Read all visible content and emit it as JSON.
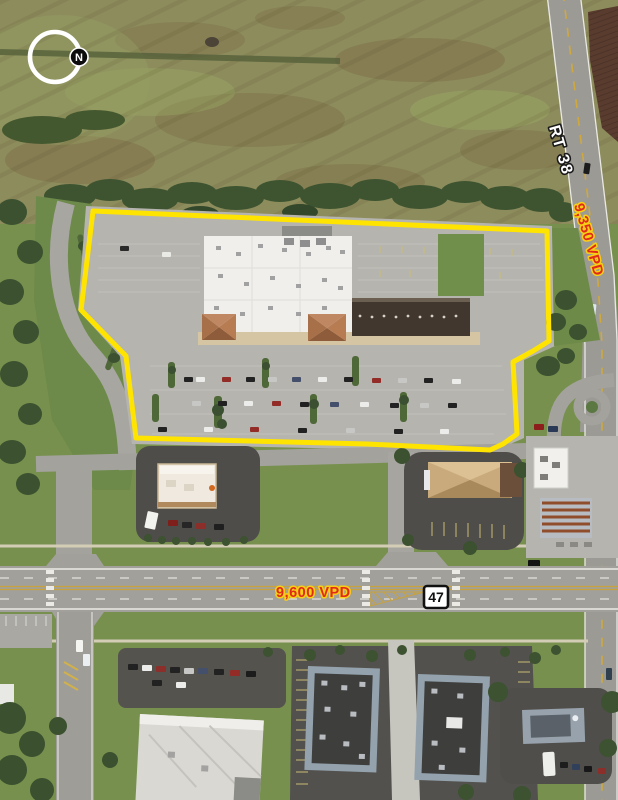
{
  "map": {
    "type": "retail-aerial",
    "compass": {
      "north_label": "N"
    },
    "property_outline": {
      "color_name": "yellow",
      "style": "solid"
    },
    "roads": [
      {
        "name": "RT 38",
        "label": "RT 38",
        "traffic_count": "9,350 VPD",
        "orientation": "diagonal-northeast"
      },
      {
        "name": "Route 47",
        "shield": "47",
        "traffic_count": "9,600 VPD",
        "orientation": "east-west"
      }
    ],
    "labels": {
      "rt38": "RT 38",
      "rt38_vpd": "9,350 VPD",
      "route47_vpd": "9,600 VPD",
      "route47_shield": "47",
      "compass_n": "N"
    },
    "colors": {
      "outline-yellow": "#FFE400",
      "vpd-red": "#E02A1C",
      "vpd-halo": "#F8CF15",
      "road-label-fill": "#FFFFFF",
      "road-label-stroke": "#1A1A1A",
      "shield-bg": "#FFFFFF",
      "shield-border": "#111111"
    }
  }
}
